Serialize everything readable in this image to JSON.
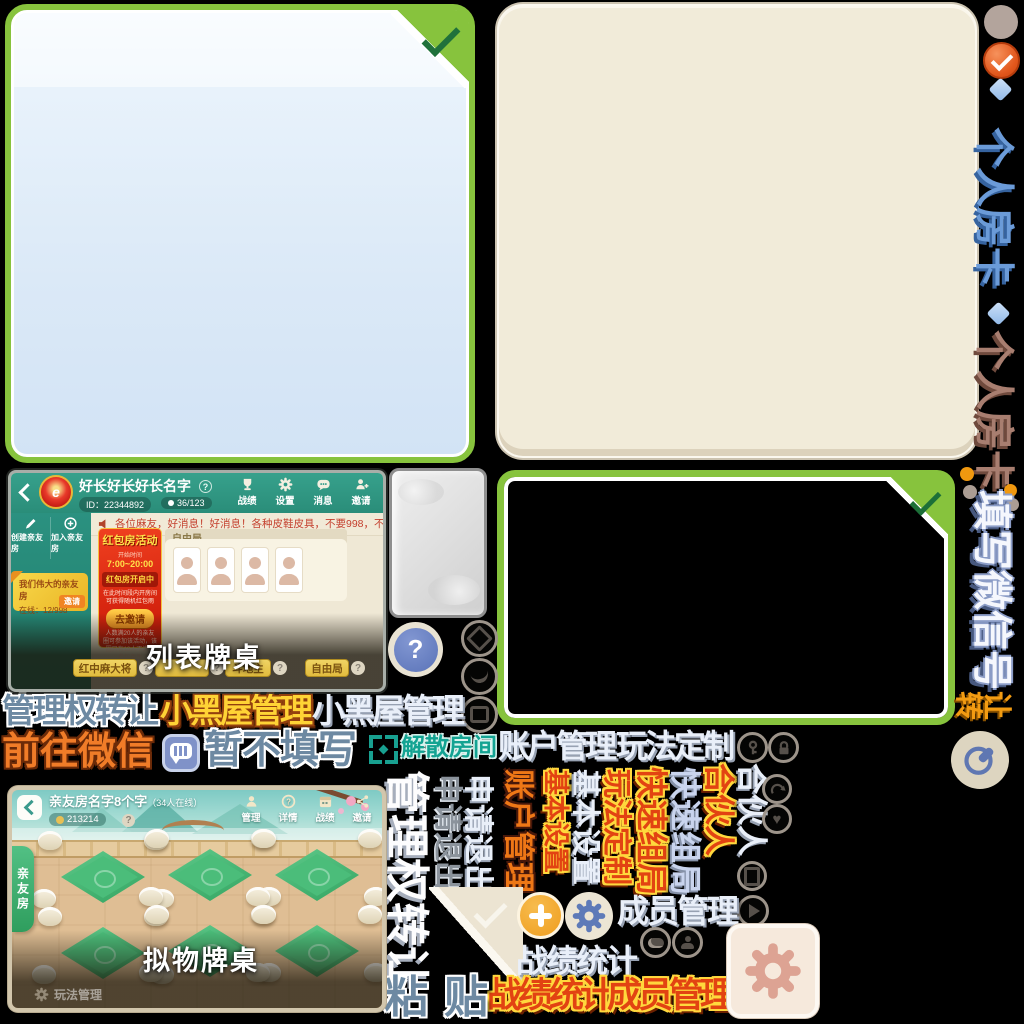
{
  "colors": {
    "panel_border_green": "#87c33d",
    "check_dark_green": "#1e7a40",
    "panel_blue_fill": "#e3eefa",
    "panel_beige_fill": "#f1ebd9",
    "orange_check_circle": "#e2571c",
    "plus_button_orange": "#f2a62c",
    "gear_blue": "#5e7ab8",
    "gear_salmon": "#dda393",
    "icon_taupe": "#9d948a",
    "teal_header": "#2f9a87",
    "table_green": "#3fae6e"
  },
  "rail": {
    "card_blue": "个人房卡",
    "card_brown": "个人房卡",
    "fill_wechat": "填写微信号",
    "transfer": [
      "转",
      "让"
    ]
  },
  "labels": {
    "row1_transfer": "管理权转让",
    "row1_blackroom_yellow": "小黑屋管理",
    "row1_blackroom_light": "小黑屋管理",
    "row2_goto_wechat": "前往微信",
    "row2_not_fill": "暂不填写",
    "row2_dissolve": "解散房间",
    "row2_account": "账户管理",
    "row2_gameplay": "玩法定制",
    "paste_left": "粘",
    "paste_right": "贴",
    "members_light": "成员管理",
    "stats_light": "战绩统计",
    "stats_orange": "战绩统计",
    "members_orange": "成员管理"
  },
  "vcols": [
    {
      "text": "管理权转让"
    },
    {
      "text": "申请退出"
    },
    {
      "text": "申请退出"
    },
    {
      "text": "账户管理"
    },
    {
      "text": "基本设置"
    },
    {
      "text": "基本设置"
    },
    {
      "text": "玩法定制"
    },
    {
      "text": "快速组局"
    },
    {
      "text": "快速组局"
    },
    {
      "text": "合伙人"
    },
    {
      "text": "合伙人"
    }
  ],
  "list_room": {
    "caption": "列表牌桌",
    "title": "好长好长好长名字",
    "id": "ID：22344892",
    "members": "36/123",
    "nav": [
      {
        "label": "战绩"
      },
      {
        "label": "设置"
      },
      {
        "label": "消息"
      },
      {
        "label": "邀请"
      }
    ],
    "create_btn": "创建亲友房",
    "join_btn": "加入亲友房",
    "banner_title": "我们伟大的亲友房",
    "banner_online": "在线：12/998",
    "banner_btn": "邀请",
    "marquee": "各位麻友，好消息！好消息！各种皮鞋皮具，不要998，不要688，只要98元，只要9",
    "poster": {
      "title": "红包房活动",
      "time_label": "开始时间",
      "time": "7:00~20:00",
      "status": "红包房开启中",
      "desc": "在此时间段内开房间可获得随机红包雨",
      "button": "去邀请",
      "note": "人数满20人的亲友圈可参加该活动，该圈只有13人不满足参与条件"
    },
    "free_mode": "自由局",
    "tabs": [
      {
        "label": "红中麻大将"
      },
      {
        "label": ""
      },
      {
        "label": "斗地主"
      },
      {
        "label": "自由局"
      }
    ]
  },
  "scene_room": {
    "caption": "拟物牌桌",
    "title": "亲友房名字8个字",
    "online": "（34人在线）",
    "room_id": "213214",
    "nav": [
      {
        "label": "管理"
      },
      {
        "label": "详情"
      },
      {
        "label": "战绩"
      },
      {
        "label": "邀请"
      }
    ],
    "side_tab": "亲友房",
    "bottom_manage": "玩法管理"
  }
}
